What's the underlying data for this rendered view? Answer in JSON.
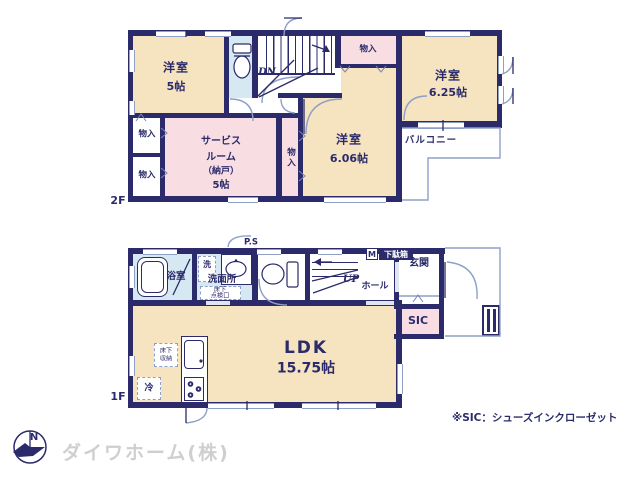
{
  "colors": {
    "wall": "#2b2b6b",
    "cream": "#f6e3c0",
    "pink": "#f8dde3",
    "blue": "#d6e9f2",
    "winline": "#8ea0c8",
    "text": "#2b2b6b"
  },
  "floor2": {
    "label": "2F",
    "bedroom1": {
      "name": "洋室",
      "size": "5帖"
    },
    "bedroom2": {
      "name": "洋室",
      "size": "6.25帖"
    },
    "bedroom3": {
      "name": "洋室",
      "size": "6.06帖"
    },
    "service_room": {
      "l1": "サービス",
      "l2": "ルーム",
      "l3": "（納戸）",
      "l4": "5帖"
    },
    "closet_top": "物入",
    "closet_left1": "物入",
    "closet_left2": "物入",
    "closet_mid": "物入",
    "balcony": "バルコニー",
    "dn": "DN"
  },
  "floor1": {
    "label": "1F",
    "bath": "浴室",
    "laundry": "洗",
    "washroom": "洗面所",
    "ps": "P.S",
    "underfloor_access": {
      "l1": "床下",
      "l2": "点検口"
    },
    "up": "UP",
    "hall": "ホール",
    "mirror": "M",
    "shoebox": "下駄箱",
    "entrance": "玄関",
    "sic": "SIC",
    "ldk": {
      "name": "LDK",
      "size": "15.75帖"
    },
    "underfloor_storage": {
      "l1": "床下",
      "l2": "収納"
    },
    "fridge": "冷"
  },
  "footer": {
    "note": "※SIC：シューズインクローゼット",
    "company": "ダイワホーム(株)",
    "compass_n": "N"
  }
}
